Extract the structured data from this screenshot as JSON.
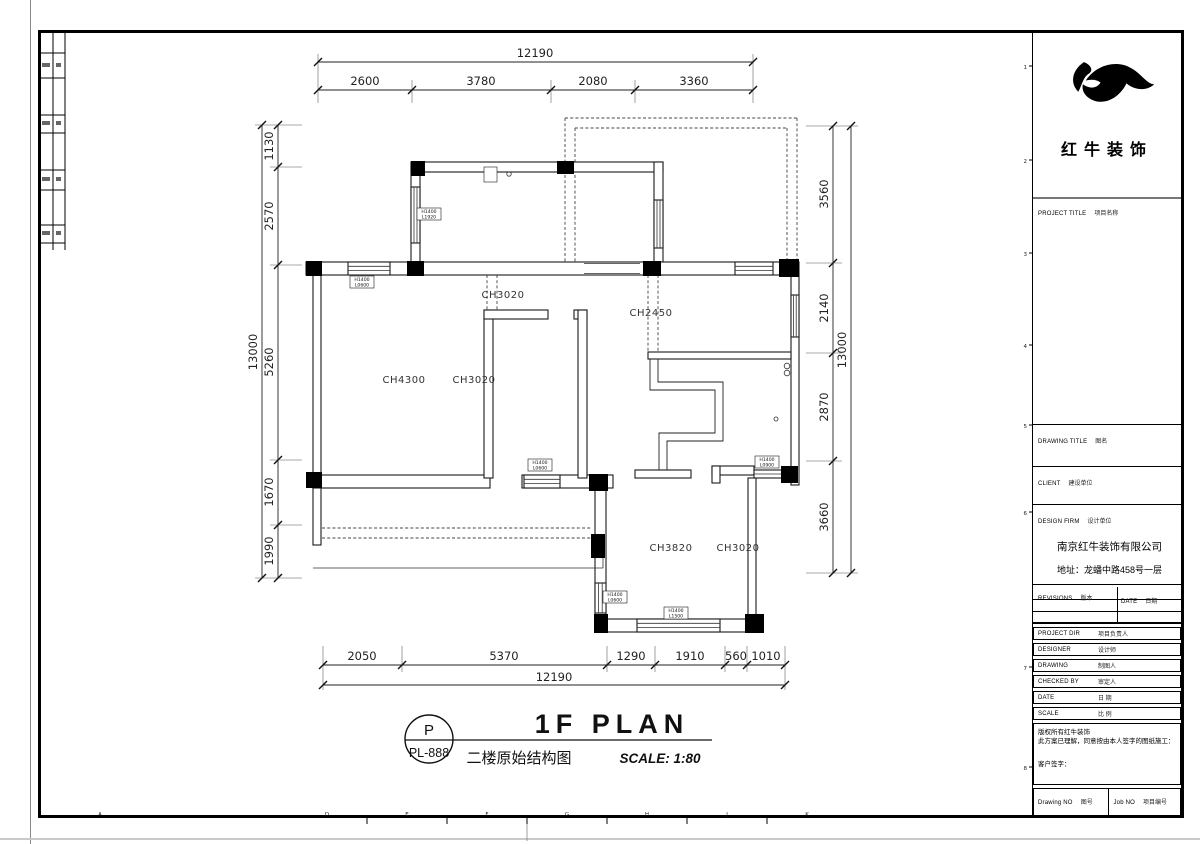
{
  "brand": {
    "name": "红牛装饰"
  },
  "tb": {
    "project_title_en": "PROJECT TITLE",
    "project_title_zh": "项目名称",
    "drawing_title_en": "DRAWING TITLE",
    "drawing_title_zh": "图名",
    "client_en": "CLIENT",
    "client_zh": "建设单位",
    "design_firm_en": "DESIGN FIRM",
    "design_firm_zh": "设计单位",
    "company_name": "南京红牛装饰有限公司",
    "company_address": "地址：龙蟠中路458号一层",
    "revisions_en": "REVISIONS",
    "revisions_zh": "版本",
    "date_col_en": "DATE",
    "date_col_zh": "日期",
    "project_dir_en": "PROJECT DIR",
    "project_dir_zh": "项目负责人",
    "designer_en": "DESIGNER",
    "designer_zh": "设计师",
    "drawing_en": "DRAWING",
    "drawing_zh": "制图人",
    "checked_en": "CHECKED BY",
    "checked_zh": "审定人",
    "date_en": "DATE",
    "date_zh": "日 期",
    "scale_en": "SCALE",
    "scale_zh": "比 例",
    "note1": "版权所有红牛装饰",
    "note2": "此方案已理解，同意按由本人签字的图纸施工：",
    "note3": "客户签字：",
    "drawing_no_en": "Drawing NO",
    "drawing_no_zh": "图号",
    "job_no_en": "Job NO",
    "job_no_zh": "项目编号"
  },
  "pt": {
    "letter": "P",
    "code": "PL-888",
    "title": "1F PLAN",
    "subtitle": "二楼原始结构图",
    "scale": "SCALE: 1:80"
  },
  "dims": {
    "top": {
      "overall": "12190",
      "seg0": "2600",
      "seg1": "3780",
      "seg2": "2080",
      "seg3": "3360"
    },
    "bottom": {
      "overall": "12190",
      "seg0": "2050",
      "seg1": "5370",
      "seg2": "1290",
      "seg3": "1910",
      "seg4": "560",
      "seg5": "1010"
    },
    "left": {
      "overall": "13000",
      "seg0": "1130",
      "seg1": "2570",
      "seg2": "5260",
      "seg3": "1670",
      "seg4": "1990"
    },
    "right": {
      "overall": "13000",
      "seg0": "3560",
      "seg1": "2140",
      "seg2": "2870",
      "seg3": "3660"
    }
  },
  "rooms": {
    "r1": "CH3020",
    "r2": "CH2450",
    "r3": "CH4300",
    "r4": "CH3020",
    "r5": "CH3820",
    "r6": "CH3020"
  },
  "win": {
    "w1h": "H1400",
    "w1l": "L1920",
    "w2h": "H1400",
    "w2l": "L0600",
    "w3h": "H1400",
    "w3l": "L0600",
    "w4h": "H1400",
    "w4l": "L0900",
    "w5h": "H1400",
    "w5l": "L0600",
    "w6h": "H1400",
    "w6l": "L1500"
  },
  "grid": {
    "bottom_letters": [
      "A",
      "D",
      "E",
      "F",
      "G",
      "H",
      "J",
      "K"
    ],
    "right_numbers": [
      "1",
      "2",
      "3",
      "4",
      "5",
      "6",
      "7",
      "8"
    ]
  }
}
